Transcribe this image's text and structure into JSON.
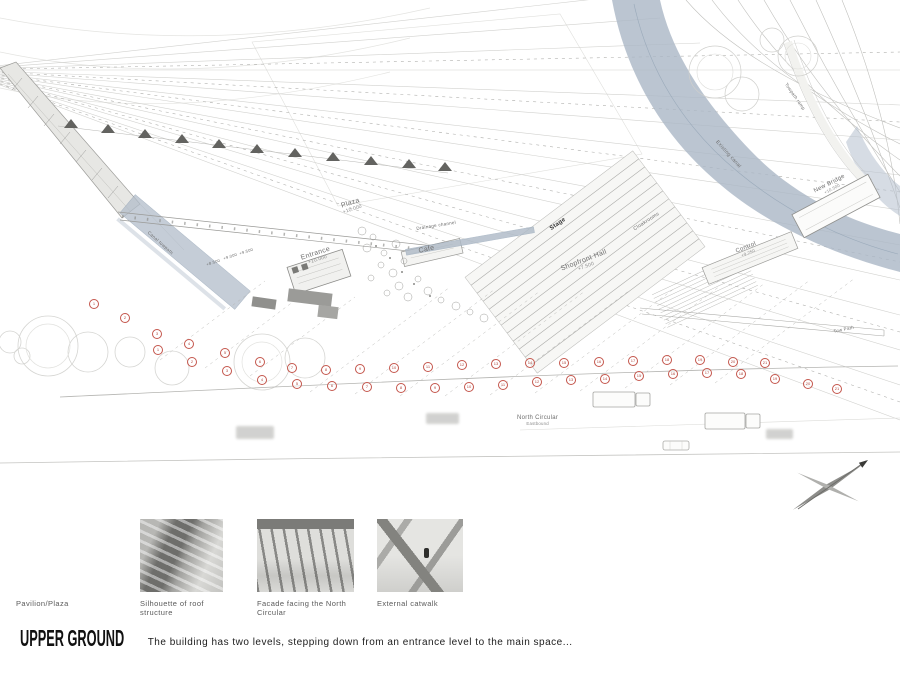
{
  "plan": {
    "labels": [
      {
        "text": "Plaza",
        "sub": "+10.000",
        "x": 340,
        "y": 203,
        "rot": -18,
        "size": 7
      },
      {
        "text": "Entrance",
        "sub": "+10.000",
        "x": 300,
        "y": 255,
        "rot": -18,
        "size": 7
      },
      {
        "text": "Cafe",
        "sub": "",
        "x": 418,
        "y": 248,
        "rot": -13,
        "size": 7
      },
      {
        "text": "Drainage channel",
        "sub": "",
        "x": 416,
        "y": 226,
        "rot": -9,
        "size": 4.5
      },
      {
        "text": "Stage",
        "sub": "",
        "x": 549,
        "y": 227,
        "rot": -35,
        "size": 6,
        "dark": true
      },
      {
        "text": "Cloakrooms",
        "sub": "",
        "x": 633,
        "y": 228,
        "rot": -33,
        "size": 5
      },
      {
        "text": "Shopfront Hall",
        "sub": "+7.500",
        "x": 560,
        "y": 266,
        "rot": -21,
        "size": 7
      },
      {
        "text": "Control",
        "sub": "+9.250",
        "x": 735,
        "y": 249,
        "rot": -22,
        "size": 6
      },
      {
        "text": "New Bridge",
        "sub": "+10.500",
        "x": 813,
        "y": 189,
        "rot": -27,
        "size": 6
      },
      {
        "text": "Existing canal",
        "sub": "",
        "x": 718,
        "y": 140,
        "rot": 48,
        "size": 5
      },
      {
        "text": "Towpath ramp",
        "sub": "",
        "x": 788,
        "y": 82,
        "rot": 55,
        "size": 4.5
      },
      {
        "text": "Canal towpath",
        "sub": "",
        "x": 150,
        "y": 230,
        "rot": 42,
        "size": 4.5
      },
      {
        "text": "+8.500",
        "sub": "",
        "x": 206,
        "y": 263,
        "rot": -18,
        "size": 4
      },
      {
        "text": "+9.000",
        "sub": "",
        "x": 223,
        "y": 257,
        "rot": -18,
        "size": 4
      },
      {
        "text": "+9.500",
        "sub": "",
        "x": 239,
        "y": 252,
        "rot": -18,
        "size": 4
      },
      {
        "text": "Tow Path",
        "sub": "",
        "x": 833,
        "y": 329,
        "rot": -12,
        "size": 4.5
      },
      {
        "text": "North Circular",
        "sub": "Eastbound",
        "x": 517,
        "y": 415,
        "rot": 0,
        "size": 6
      }
    ],
    "markers": [
      {
        "n": "1",
        "x": 93,
        "y": 303
      },
      {
        "n": "2",
        "x": 124,
        "y": 317
      },
      {
        "n": "3",
        "x": 156,
        "y": 333
      },
      {
        "n": "4",
        "x": 188,
        "y": 343
      },
      {
        "n": "5",
        "x": 224,
        "y": 352
      },
      {
        "n": "6",
        "x": 259,
        "y": 361
      },
      {
        "n": "7",
        "x": 291,
        "y": 367
      },
      {
        "n": "8",
        "x": 325,
        "y": 369
      },
      {
        "n": "9",
        "x": 359,
        "y": 368
      },
      {
        "n": "10",
        "x": 393,
        "y": 367
      },
      {
        "n": "11",
        "x": 427,
        "y": 366
      },
      {
        "n": "12",
        "x": 461,
        "y": 364
      },
      {
        "n": "13",
        "x": 495,
        "y": 363
      },
      {
        "n": "14",
        "x": 529,
        "y": 362
      },
      {
        "n": "15",
        "x": 563,
        "y": 362
      },
      {
        "n": "16",
        "x": 598,
        "y": 361
      },
      {
        "n": "17",
        "x": 632,
        "y": 360
      },
      {
        "n": "18",
        "x": 666,
        "y": 359
      },
      {
        "n": "19",
        "x": 699,
        "y": 359
      },
      {
        "n": "20",
        "x": 732,
        "y": 361
      },
      {
        "n": "21",
        "x": 764,
        "y": 362
      },
      {
        "n": "1",
        "x": 157,
        "y": 349
      },
      {
        "n": "2",
        "x": 191,
        "y": 361
      },
      {
        "n": "3",
        "x": 226,
        "y": 370
      },
      {
        "n": "4",
        "x": 261,
        "y": 379
      },
      {
        "n": "5",
        "x": 296,
        "y": 383
      },
      {
        "n": "6",
        "x": 331,
        "y": 385
      },
      {
        "n": "7",
        "x": 366,
        "y": 386
      },
      {
        "n": "8",
        "x": 400,
        "y": 387
      },
      {
        "n": "9",
        "x": 434,
        "y": 387
      },
      {
        "n": "10",
        "x": 468,
        "y": 386
      },
      {
        "n": "11",
        "x": 502,
        "y": 384
      },
      {
        "n": "12",
        "x": 536,
        "y": 381
      },
      {
        "n": "13",
        "x": 570,
        "y": 379
      },
      {
        "n": "14",
        "x": 604,
        "y": 378
      },
      {
        "n": "15",
        "x": 638,
        "y": 375
      },
      {
        "n": "16",
        "x": 672,
        "y": 373
      },
      {
        "n": "17",
        "x": 706,
        "y": 372
      },
      {
        "n": "18",
        "x": 740,
        "y": 373
      },
      {
        "n": "19",
        "x": 774,
        "y": 378
      },
      {
        "n": "20",
        "x": 807,
        "y": 383
      },
      {
        "n": "21",
        "x": 836,
        "y": 388
      }
    ],
    "colors": {
      "canal": "#aab7c6",
      "marker_red": "#c4564c",
      "line_gray": "#ababa8"
    }
  },
  "thumbnails": {
    "items": [
      {
        "caption": "Pavilion/Plaza"
      },
      {
        "caption": "Silhouette of roof structure"
      },
      {
        "caption": "Facade facing the North Circular"
      },
      {
        "caption": "External catwalk"
      }
    ]
  },
  "footer": {
    "title": "UPPER GROUND",
    "description": "The building has two levels, stepping down from an entrance level to the main space..."
  }
}
